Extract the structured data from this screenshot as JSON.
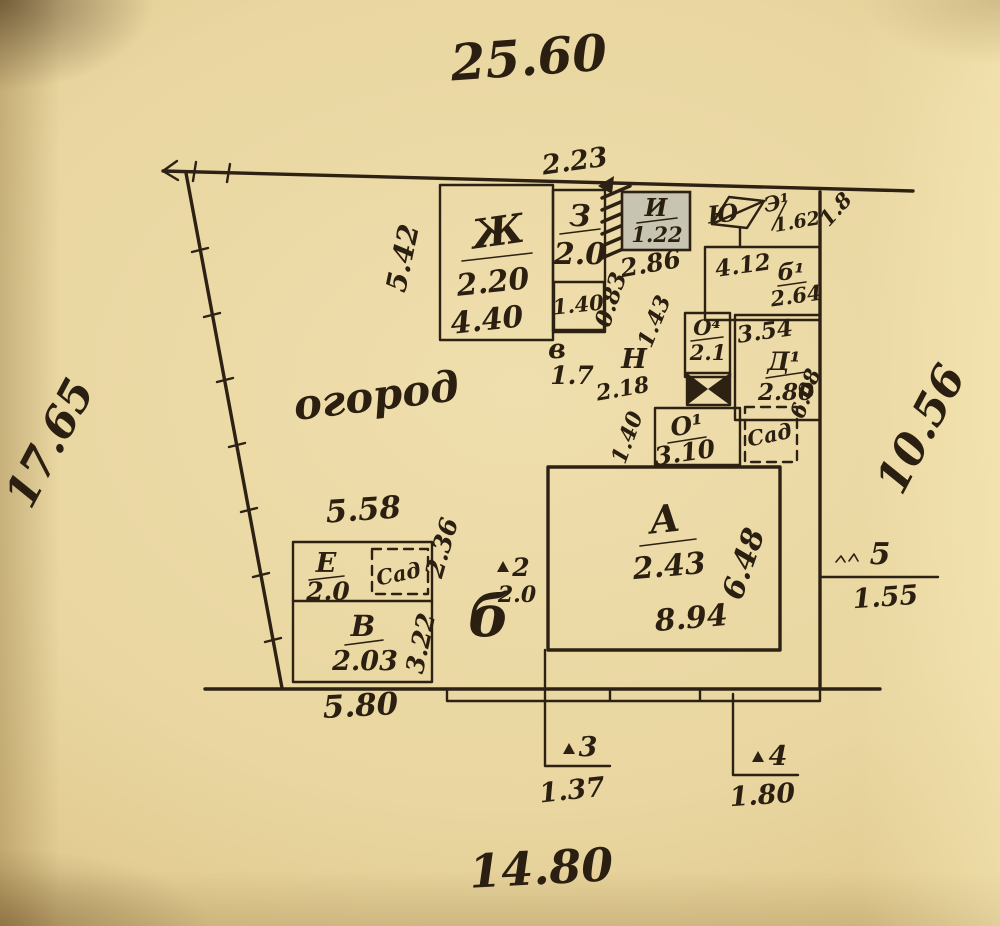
{
  "site": {
    "top": "25.60",
    "left": "17.65",
    "right": "10.56",
    "bottom": "14.80",
    "garden": "огород"
  },
  "bld": {
    "zh": {
      "label": "Ж",
      "h": "2.20",
      "w": "4.40",
      "side": "5.42"
    },
    "z": {
      "label": "З",
      "h": "2.0",
      "top": "2.23",
      "inner": "1.40",
      "sub_label": "в",
      "sub": "1.7"
    },
    "i": {
      "label": "И",
      "h": "1.22",
      "below": "2.86",
      "side": "0.83"
    },
    "yu": {
      "label": "Ю",
      "e1": "Э¹",
      "e1v": "1.62",
      "corner": "1.8"
    },
    "b1": {
      "label": "б¹",
      "w": "4.12",
      "h": "2.64"
    },
    "o4": {
      "label": "О⁴",
      "h": "2.1"
    },
    "d1": {
      "label": "Д¹",
      "w": "3.54",
      "h": "2.80",
      "side": "6.08"
    },
    "n": {
      "label": "Н",
      "h": "2.18",
      "d1": "1.43",
      "d2": "1.40"
    },
    "o1": {
      "label": "О¹",
      "h": "3.10"
    },
    "sad_r": "Сад",
    "a": {
      "label": "А",
      "h": "2.43",
      "w": "8.94",
      "side": "6.48"
    },
    "e": {
      "label": "Е",
      "h": "2.0",
      "top": "5.58",
      "side": "2.36",
      "sad": "Сад"
    },
    "v": {
      "label": "В",
      "h": "2.03",
      "side": "3.22",
      "bottom": "5.80"
    }
  },
  "pts": {
    "p2": {
      "n": "2",
      "label": "б",
      "v": "2.0"
    },
    "p3": {
      "n": "3",
      "v": "1.37"
    },
    "p4": {
      "n": "4",
      "v": "1.80"
    },
    "p5": {
      "n": "5",
      "v": "1.55"
    }
  }
}
